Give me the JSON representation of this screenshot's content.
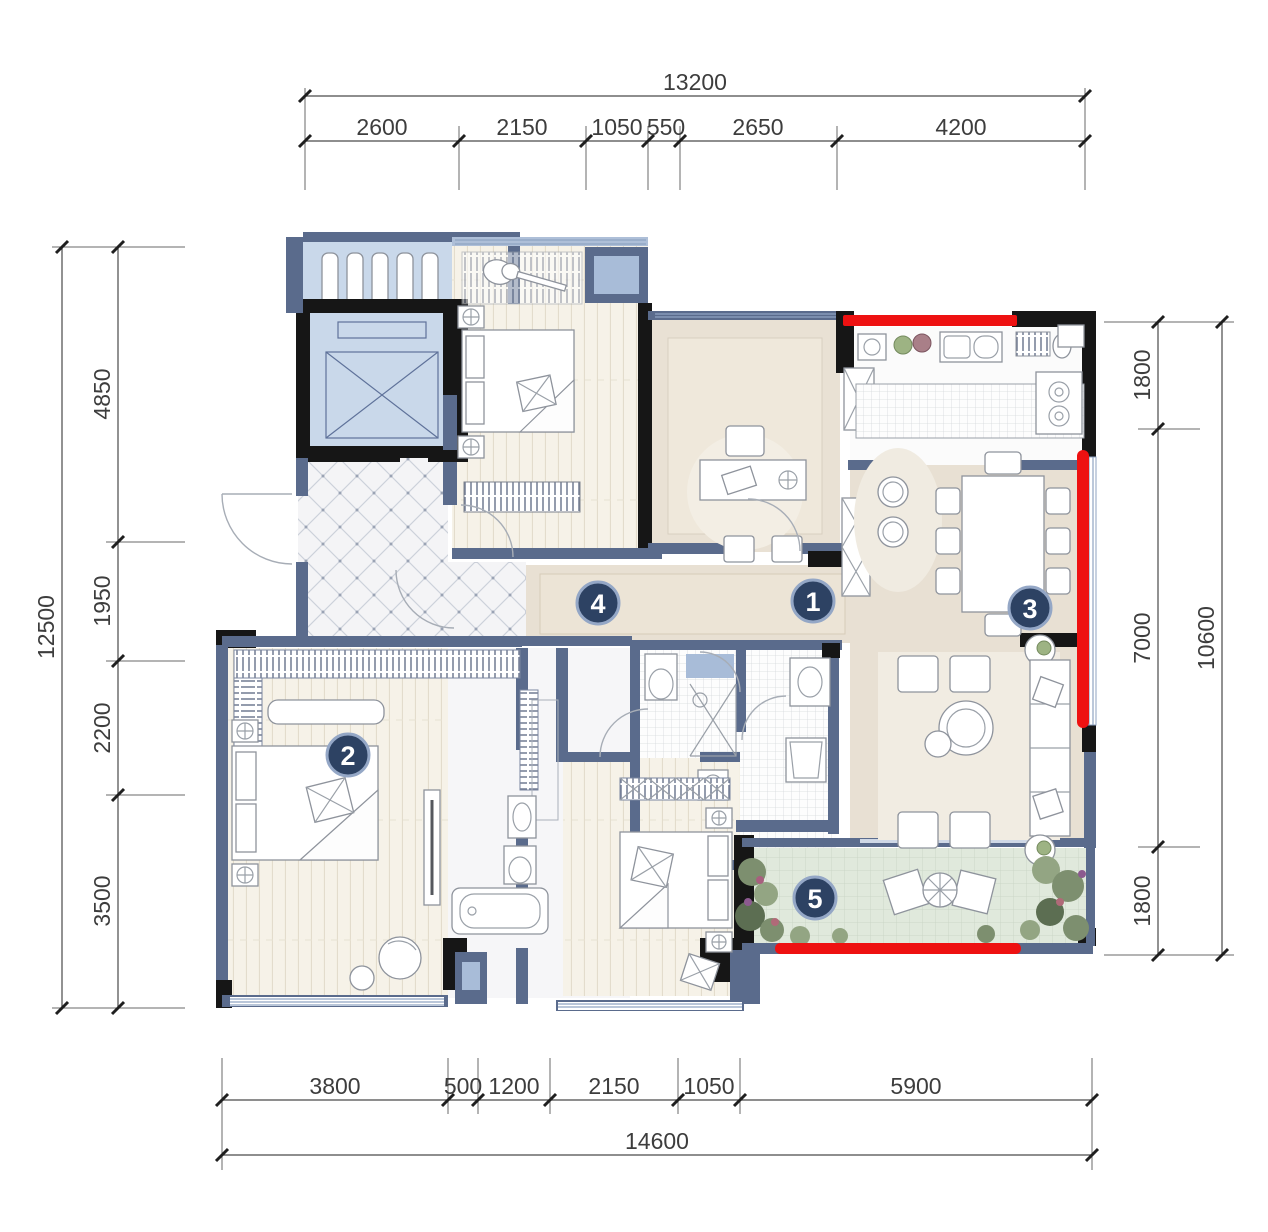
{
  "drawing": {
    "type": "apartment-floor-plan",
    "units": "mm"
  },
  "dimensions": {
    "top": {
      "total": "13200",
      "segments": [
        "2600",
        "2150",
        "1050",
        "550",
        "2650",
        "4200"
      ]
    },
    "left": {
      "total": "12500",
      "segments": [
        "4850",
        "1950",
        "2200",
        "3500"
      ]
    },
    "right": {
      "total": "10600",
      "segments": [
        "1800",
        "7000",
        "1800"
      ]
    },
    "bottom": {
      "total": "14600",
      "segments": [
        "3800",
        "500",
        "1200",
        "2150",
        "1050",
        "5900"
      ]
    }
  },
  "room_markers": [
    {
      "label": "1"
    },
    {
      "label": "2"
    },
    {
      "label": "3"
    },
    {
      "label": "4"
    },
    {
      "label": "5"
    }
  ],
  "colors": {
    "highlight": "#ee1111",
    "marker": "#2d4263",
    "marker_ring": "#94a7c6",
    "wall": "#5a6b8c",
    "structural": "#161616",
    "balcony_floor": "#dde7d9",
    "wood_floor": "#f5f1e7",
    "marble_floor": "#e8e0d3"
  }
}
